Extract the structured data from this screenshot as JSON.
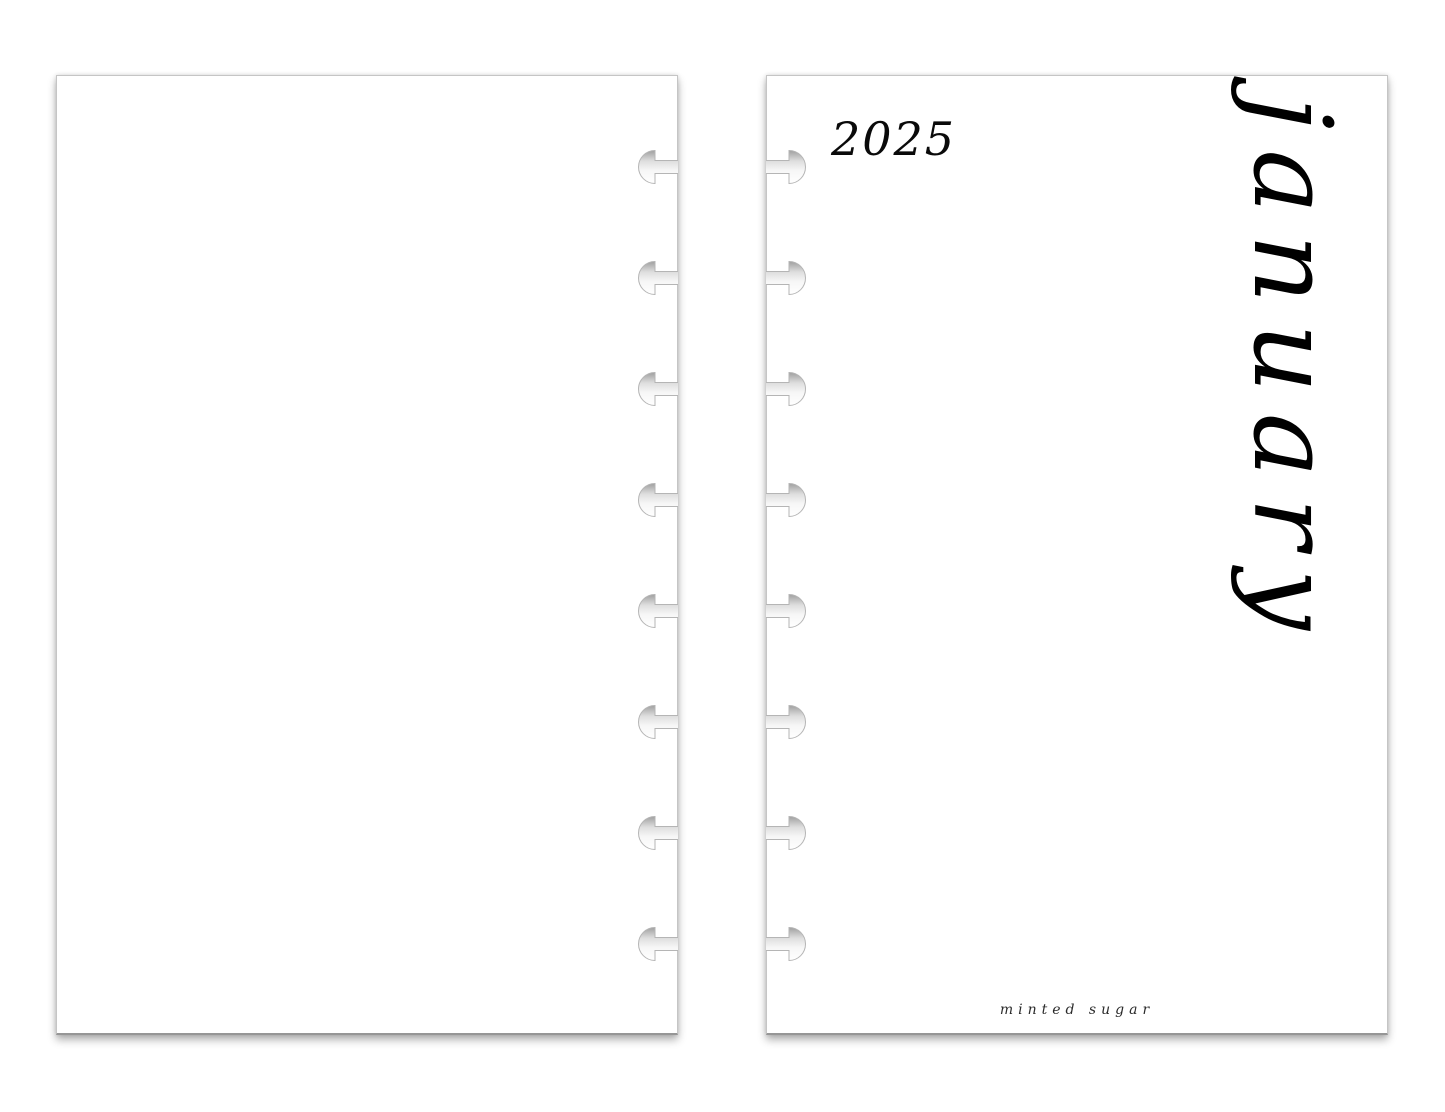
{
  "scene": {
    "background_color": "#ffffff",
    "page_color": "#ffffff",
    "ink_color": "#000000",
    "page_edge_color": "#c5c5c5"
  },
  "binding": {
    "holes_per_page": 8,
    "hole_style": "disc-punch-hole"
  },
  "right_page": {
    "year_label": "2025",
    "month_label": "january",
    "brand_label": "minted sugar"
  }
}
